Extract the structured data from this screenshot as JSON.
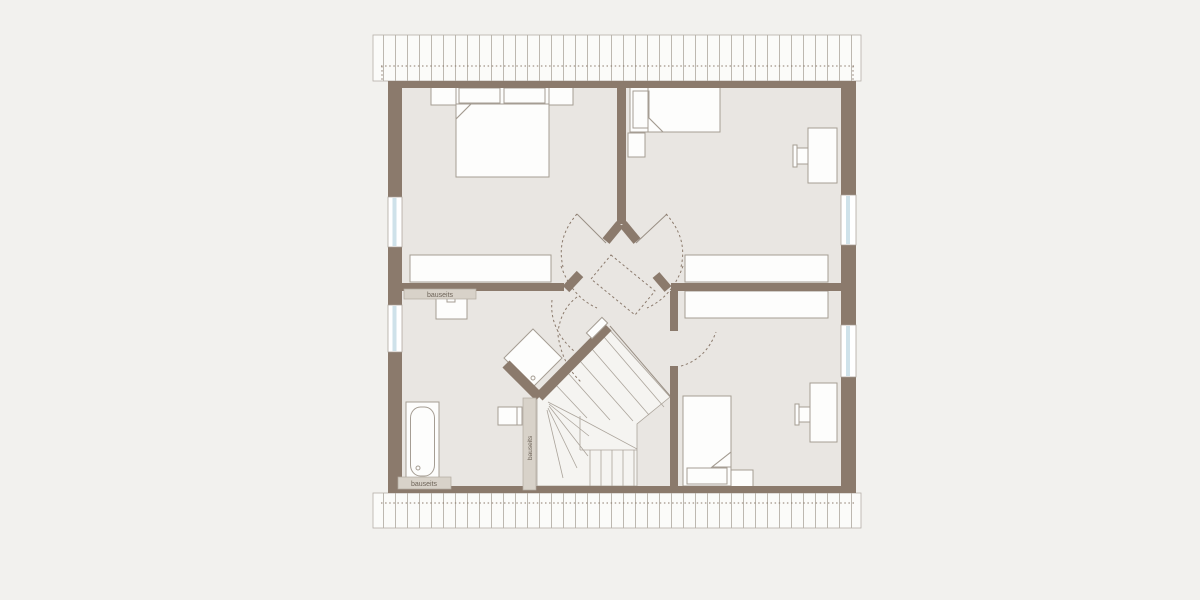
{
  "plan": {
    "labels": {
      "bauseits_bath_wall": "bauseits",
      "bauseits_stair_wall": "bauseits",
      "bauseits_tub": "bauseits"
    }
  },
  "colors": {
    "background": "#f2f1ee",
    "room_fill": "#e9e6e2",
    "wall": "#8b7a6c",
    "bauseits_fill": "#d8d2c9",
    "bauseits_stroke": "#b3aaa0",
    "furniture_fill": "#fdfdfc",
    "furniture_stroke": "#a59d93",
    "stair_fill": "#f5f4f1",
    "stair_line": "#aba49b",
    "hatch_bg": "#fbfbf9",
    "hatch_line": "#b6b0a8",
    "dotted": "#8b7a6c",
    "door_leaf": "#998f84",
    "window_glass": "#cfe2ea",
    "text": "#6e6459"
  }
}
